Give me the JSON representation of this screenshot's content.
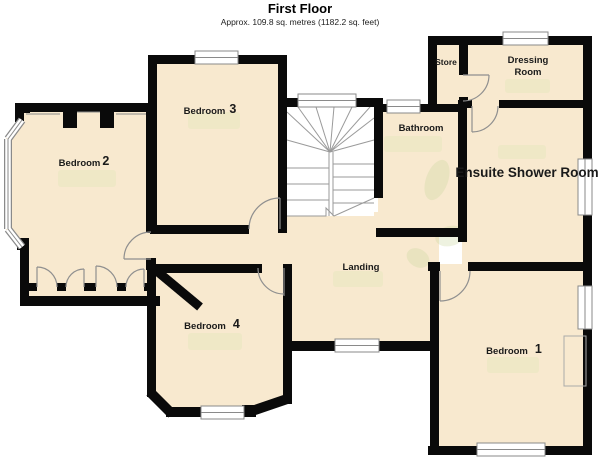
{
  "header": {
    "title": "First Floor",
    "subtitle": "Approx. 109.8 sq. metres (1182.2 sq. feet)"
  },
  "rooms": {
    "bedroom1": {
      "name": "Bedroom",
      "number": "1"
    },
    "bedroom2": {
      "name": "Bedroom",
      "number": "2"
    },
    "bedroom3": {
      "name": "Bedroom",
      "number": "3"
    },
    "bedroom4": {
      "name": "Bedroom",
      "number": "4"
    },
    "bathroom": {
      "label": "Bathroom"
    },
    "landing": {
      "label": "Landing"
    },
    "store": {
      "label": "Store"
    },
    "dressing": {
      "line1": "Dressing",
      "line2": "Room"
    },
    "ensuite": {
      "label": "Ensuite Shower Room"
    }
  },
  "colors": {
    "wall": "#0a0a0a",
    "floor": "#f8e9cf",
    "window_fill": "#ffffff",
    "window_frame": "#8a8a8a",
    "hint": "#ece7c3",
    "plant": "#c9d6a0",
    "stair_line": "#9a9a9a",
    "label": "#1a1a1a"
  }
}
